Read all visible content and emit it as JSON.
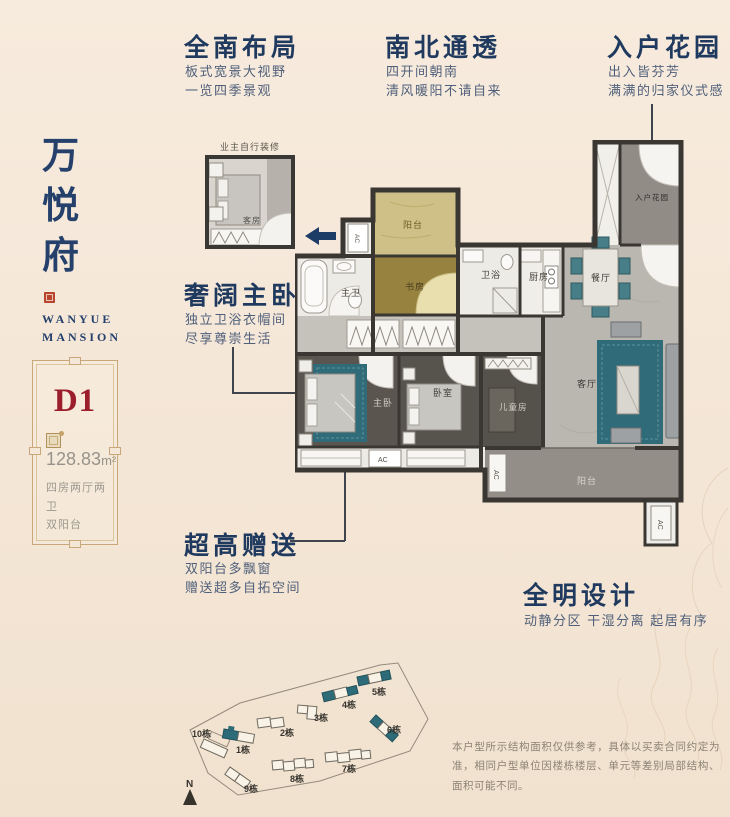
{
  "brand": {
    "name_vertical": [
      "万",
      "悦",
      "府"
    ],
    "name_en_line1": "WANYUE",
    "name_en_line2": "MANSION"
  },
  "unit_card": {
    "code": "D1",
    "area_value": "128.83",
    "area_unit": "m²",
    "spec_line1": "四房两厅两卫",
    "spec_line2": "双阳台"
  },
  "callouts": {
    "south_layout": {
      "title": "全南布局",
      "line1": "板式宽景大视野",
      "line2": "一览四季景观"
    },
    "ventilation": {
      "title": "南北通透",
      "line1": "四开间朝南",
      "line2": "清风暖阳不请自来"
    },
    "entry_garden": {
      "title": "入户花园",
      "line1": "出入皆芬芳",
      "line2": "满满的归家仪式感"
    },
    "master_suite": {
      "title": "奢阔主卧",
      "line1": "独立卫浴衣帽间",
      "line2": "尽享尊崇生活"
    },
    "bonus_space": {
      "title": "超高赠送",
      "line1": "双阳台多飘窗",
      "line2": "赠送超多自拓空间"
    },
    "bright_design": {
      "title": "全明设计",
      "line1": "动静分区 干湿分离 起居有序"
    }
  },
  "floorplan": {
    "inset": {
      "caption": "业主自行装修",
      "room": "客房"
    },
    "rooms": {
      "balcony_top": "阳台",
      "study": "书房",
      "master_bath": "主卫",
      "bath": "卫浴",
      "kitchen": "厨房",
      "dining": "餐厅",
      "entry_garden": "入户花园",
      "master_bedroom": "主卧",
      "bedroom": "卧室",
      "kids_room": "儿童房",
      "living": "客厅",
      "balcony_bottom": "阳台",
      "ac": "AC"
    }
  },
  "siteplan": {
    "north_label": "N",
    "buildings": [
      "1栋",
      "2栋",
      "3栋",
      "4栋",
      "5栋",
      "6栋",
      "7栋",
      "8栋",
      "9栋",
      "10栋"
    ]
  },
  "disclaimer": {
    "text": "本户型所示结构面积仅供参考，具体以买卖合同约定为准，相同户型单位因楼栋楼层、单元等差别局部结构、面积可能不同。"
  },
  "colors": {
    "navy": "#1f3a5e",
    "red": "#9c1d2c",
    "gold": "#b49b4e",
    "teal": "#2f6b78",
    "cream": "#f5e7d8"
  }
}
